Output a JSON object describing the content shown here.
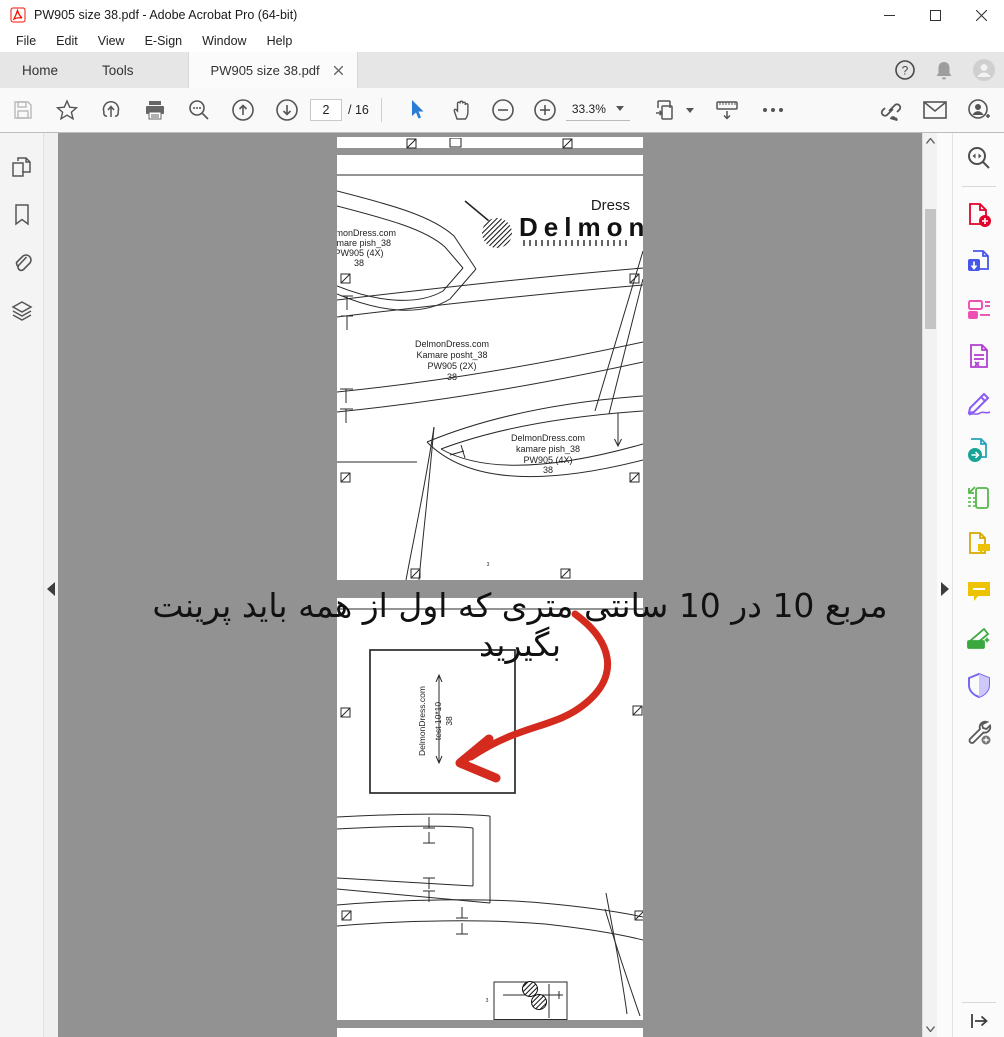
{
  "window": {
    "title": "PW905 size 38.pdf - Adobe Acrobat Pro (64-bit)"
  },
  "menu": {
    "items": [
      "File",
      "Edit",
      "View",
      "E-Sign",
      "Window",
      "Help"
    ]
  },
  "tab_bar": {
    "home": "Home",
    "tools": "Tools",
    "document_tab": "PW905 size 38.pdf"
  },
  "toolbar": {
    "page_current": "2",
    "page_total": "/ 16",
    "zoom_level": "33.3%"
  },
  "annotation": {
    "text": "مربع 10 در 10 سانتی متری که اول از همه باید پرینت بگیرید"
  },
  "document": {
    "logo": {
      "brand": "Delmon",
      "word": "Dress"
    },
    "piece_top_left": {
      "line1": "DelmonDress.com",
      "line2": "kamare pish_38",
      "line3": "PW905 (4X)",
      "line4": "38"
    },
    "piece_kamare_posht": {
      "line1": "DelmonDress.com",
      "line2": "Kamare posht_38",
      "line3": "PW905 (2X)",
      "line4": "38"
    },
    "piece_kamare_pish": {
      "line1": "DelmonDress.com",
      "line2": "kamare pish_38",
      "line3": "PW905 (4X)",
      "line4": "38"
    },
    "test_square": {
      "line1": "DelmonDress.com",
      "line2": "test 10*10",
      "line3": "38"
    },
    "sheet_number": "3"
  },
  "icons": {
    "help_glyph": "?",
    "left_rail": [
      "page-thumbnails",
      "bookmarks",
      "attachments",
      "layers"
    ],
    "right_rail": [
      "search",
      "create-pdf",
      "export-pdf",
      "edit-pdf",
      "prepare-form",
      "fill-and-sign",
      "send-pdf",
      "compress-pdf",
      "review",
      "comment",
      "scan-ocr",
      "protect",
      "more-tools"
    ],
    "toolbar": [
      "save",
      "star",
      "share-cloud",
      "print",
      "search",
      "page-up",
      "page-down",
      "select",
      "hand",
      "zoom-out",
      "zoom-in",
      "page-fit",
      "ruler",
      "more",
      "share-link",
      "email",
      "add-person"
    ]
  },
  "colors": {
    "canvas_gray": "#929292",
    "accent_blue": "#2b7cd3",
    "arrow_red": "#d42b1e",
    "acrobat_red": "#fa0f00"
  }
}
